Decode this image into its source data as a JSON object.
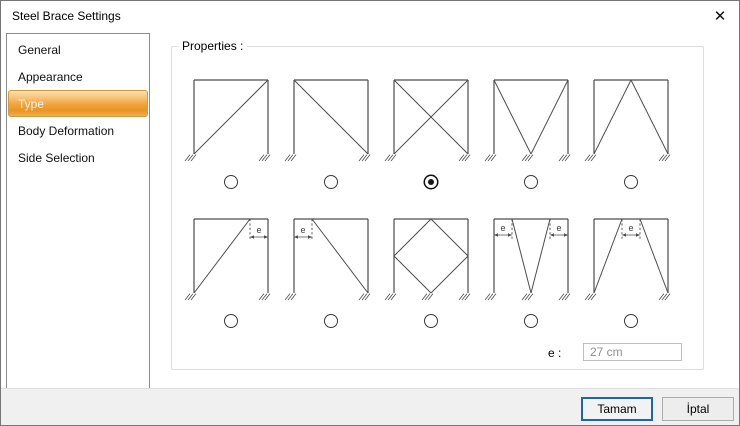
{
  "window": {
    "title": "Steel Brace Settings",
    "close_icon": "✕"
  },
  "sidebar": {
    "items": [
      {
        "label": "General",
        "selected": false
      },
      {
        "label": "Appearance",
        "selected": false
      },
      {
        "label": "Type",
        "selected": true
      },
      {
        "label": "Body Deformation",
        "selected": false
      },
      {
        "label": "Side Selection",
        "selected": false
      }
    ]
  },
  "properties": {
    "label": "Properties :",
    "e_label": "e :",
    "e_value": "27 cm",
    "brace_types": [
      {
        "id": "diagonal-up",
        "selected": false
      },
      {
        "id": "diagonal-down",
        "selected": false
      },
      {
        "id": "x-brace",
        "selected": true
      },
      {
        "id": "v-brace",
        "selected": false
      },
      {
        "id": "inverted-v-brace",
        "selected": false
      },
      {
        "id": "diagonal-up-eccentric",
        "selected": false,
        "dim_label": "e"
      },
      {
        "id": "diagonal-down-eccentric",
        "selected": false,
        "dim_label": "e"
      },
      {
        "id": "diamond-brace",
        "selected": false
      },
      {
        "id": "v-brace-eccentric",
        "selected": false,
        "dim_label": "e"
      },
      {
        "id": "inverted-v-brace-eccentric",
        "selected": false,
        "dim_label": "e"
      }
    ]
  },
  "buttons": {
    "ok": "Tamam",
    "cancel": "İptal"
  },
  "colors": {
    "accent_selected_orange": "#f0a33c",
    "default_button_border": "#1b66ad",
    "diagram_line": "#4d4d4d",
    "disabled_text": "#8f8f8f"
  }
}
